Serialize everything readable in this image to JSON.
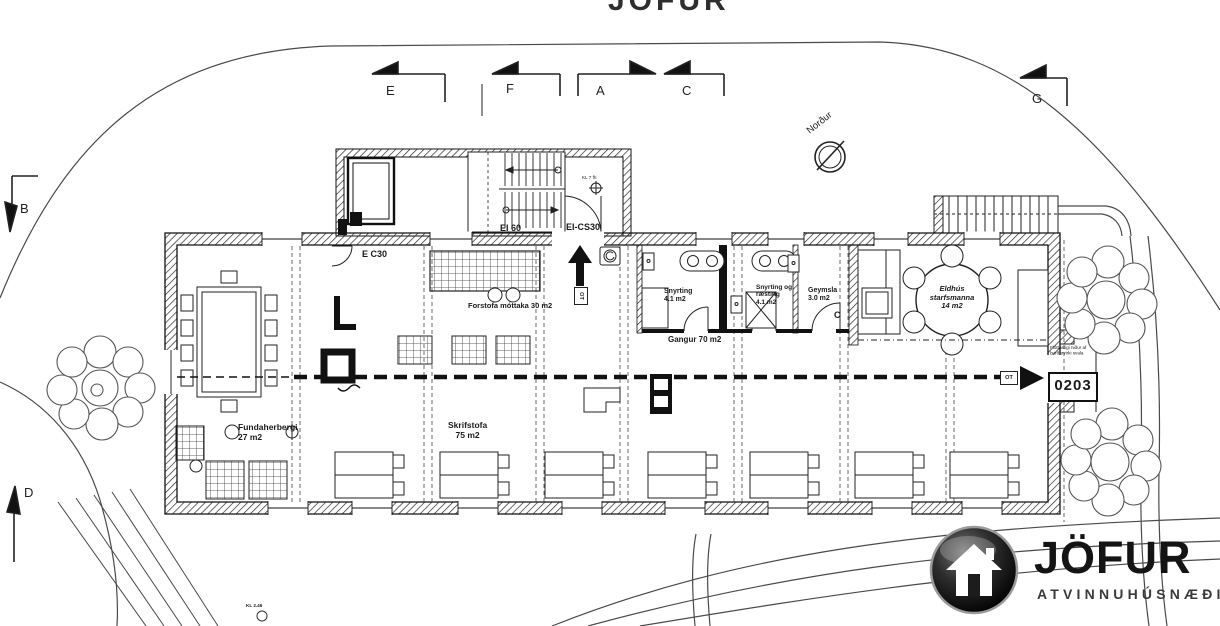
{
  "watermark": {
    "top_text": "JÖFUR"
  },
  "markers": {
    "e": "E",
    "f": "F",
    "a": "A",
    "c": "C",
    "g": "G",
    "b": "B",
    "d": "D"
  },
  "compass": {
    "label": "Norður"
  },
  "fire_labels": {
    "e_c30": "E C30",
    "ei_60": "EI 60",
    "ei_cs30": "EI-CS30",
    "kl7": "KL 7 fh"
  },
  "rooms": {
    "forstofa": {
      "label": "Forstofa  móttaka  30 m2"
    },
    "fundaherbergi": {
      "name": "Fundaherbergi",
      "area": "27 m2"
    },
    "skrifstofa": {
      "name": "Skrifstofa",
      "area": "75 m2"
    },
    "gangur": {
      "label": "Gangur 70 m2"
    },
    "snyrting": {
      "name": "Snyrting",
      "area": "4.1 m2"
    },
    "snyrting_raesting": {
      "name": "Snyrting og",
      "name2": "ræsting",
      "area": "4.1 m2"
    },
    "geymsla": {
      "name": "Geymsla",
      "area": "3.0 m2",
      "door": "C"
    },
    "eldhus": {
      "name": "Eldhús",
      "name2": "starfsmanna",
      "area": "14 m2"
    }
  },
  "annotations": {
    "room_number": "0203",
    "escape_line1": "Flóttastigi niður af",
    "escape_line2": "burðarvirki svala",
    "ot": "OT",
    "bottom_note": "KL 2.46"
  },
  "logo": {
    "brand": "JÖFUR",
    "subtitle": "ATVINNUHÚSNÆÐI"
  },
  "colors": {
    "ink": "#1a1a1a",
    "wall_hatch": "#2a2a2a",
    "site_line": "#4a4a4a"
  }
}
